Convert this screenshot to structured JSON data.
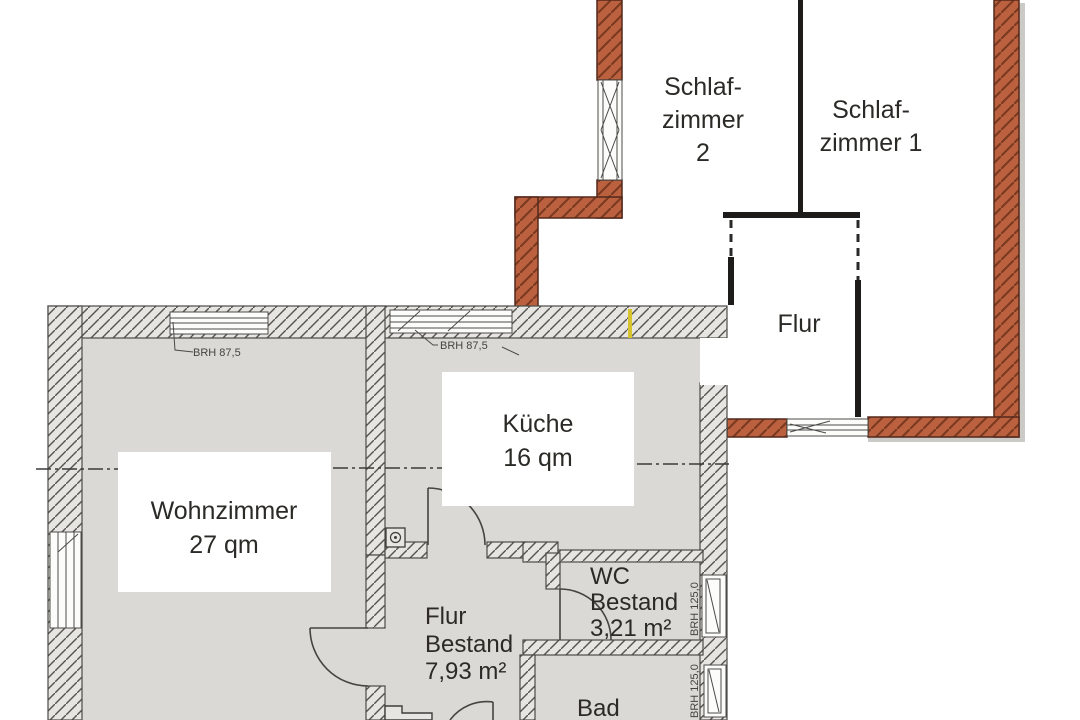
{
  "rooms": {
    "schlafzimmer2": {
      "l1": "Schlaf-",
      "l2": "zimmer",
      "l3": "2"
    },
    "schlafzimmer1": {
      "l1": "Schlaf-",
      "l2": "zimmer 1"
    },
    "flur_neubau": {
      "l1": "Flur"
    },
    "kueche": {
      "l1": "Küche",
      "l2": "16 qm"
    },
    "wohnzimmer": {
      "l1": "Wohnzimmer",
      "l2": "27 qm"
    },
    "flur_bestand": {
      "l1": "Flur",
      "l2": "Bestand",
      "l3": "7,93 m²"
    },
    "wc_bestand": {
      "l1": "WC",
      "l2": "Bestand",
      "l3": "3,21 m²"
    },
    "bad": {
      "l1": "Bad"
    }
  },
  "annotations": {
    "brh_livingroom_window": "BRH 87,5",
    "brh_kitchen_window": "BRH 87,5",
    "brh_wc_window": "BRH 125,0",
    "brh_bath_window": "BRH 125,0"
  },
  "colors": {
    "new_wall_fill": "#bc6140",
    "new_wall_hatch": "#7a3a20",
    "existing_wall_fill": "#e7e5e2",
    "existing_wall_hatch": "#56544e",
    "existing_floor": "#dbd9d5",
    "new_floor": "#ffffff",
    "line": "#2b2a27",
    "highlight_mark": "#d6c42e"
  }
}
